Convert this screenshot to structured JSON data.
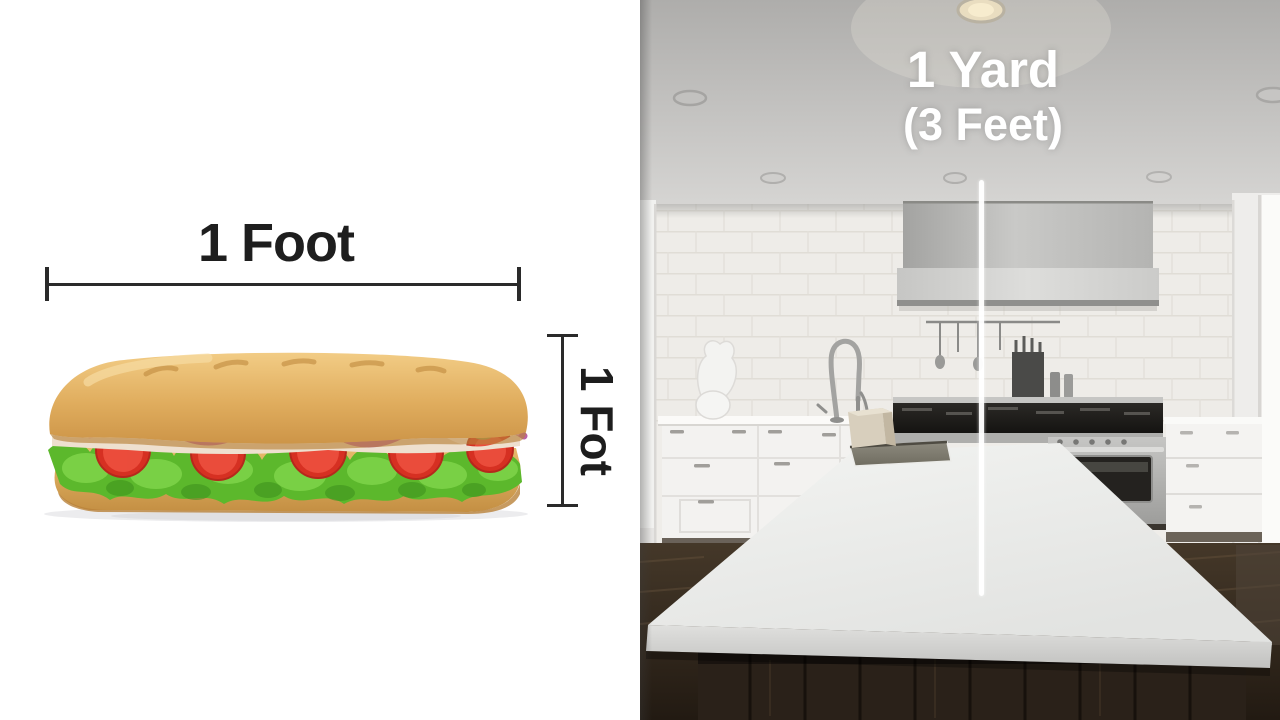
{
  "page": {
    "description": "Measurement comparison graphic: a footlong sub sandwich labeled one foot next to a kitchen photo labeled one yard"
  },
  "left_panel": {
    "width_label": "1 Foot",
    "height_label": "1 Fot",
    "object_name": "submarine-sandwich"
  },
  "right_panel": {
    "yard_label": "1 Yard",
    "feet_label": "(3 Feet)",
    "scene_name": "white-kitchen-with-island"
  },
  "colors": {
    "left_background": "#ffffff",
    "dimension_lines": "#2a2a2a",
    "left_label_text": "#1e1e1e",
    "right_label_text": "#ffffff",
    "yard_measure_line": "#ffffff",
    "bread_crust": "#d9a455",
    "lettuce": "#5cb82c",
    "tomato": "#d63022",
    "onion": "#b75a9f",
    "kitchen_ceiling": "#bdbcba",
    "kitchen_brick_wall": "#eeece8",
    "stainless_steel": "#b5b5b3",
    "island_top": "#ededeb",
    "wood_floor": "#33291f"
  }
}
